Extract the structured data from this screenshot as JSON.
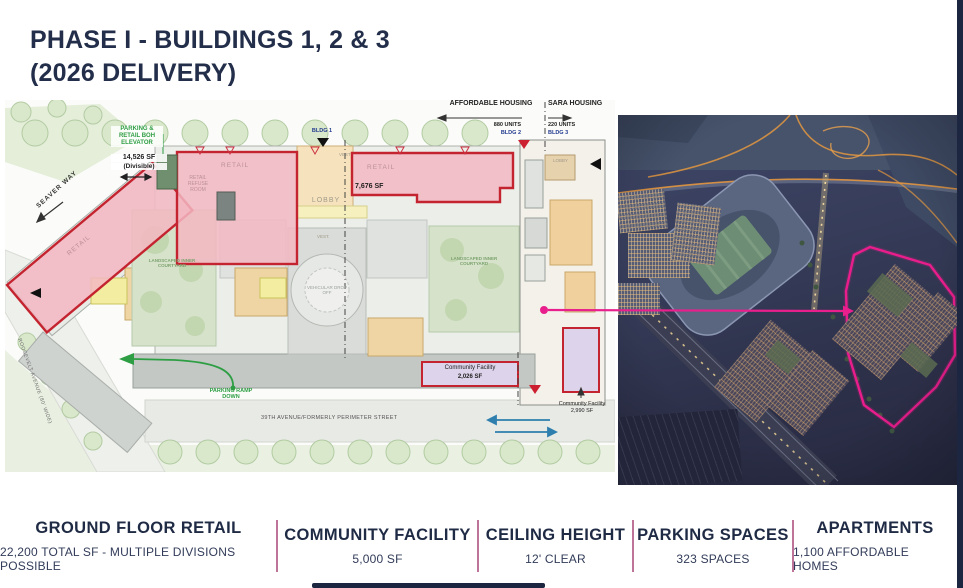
{
  "title": {
    "line1": "PHASE I - BUILDINGS 1, 2 & 3",
    "line2": "(2026 DELIVERY)"
  },
  "plan": {
    "header": {
      "affordable": {
        "title": "AFFORDABLE HOUSING",
        "units": "880 UNITS",
        "bldg": "BLDG 2"
      },
      "sara": {
        "title": "SARA HOUSING",
        "units": "220 UNITS",
        "bldg": "BLDG 3"
      },
      "bldg1": "BLDG 1"
    },
    "labels": {
      "parking_elevator": "PARKING & RETAIL BOH ELEVATOR",
      "sf_divisible": "14,526 SF",
      "sf_divisible_note": "(Divisible)",
      "retail": "RETAIL",
      "refuse_room": "RETAIL REFUSE ROOM",
      "sf_right": "7,676 SF",
      "lobby": "LOBBY",
      "vest_top": "VEST",
      "vest_mid": "VEST.",
      "lobby_bldg3": "LOBBY",
      "dropoff": "VEHICULAR DROP OFF",
      "courtyard": "LANDSCAPED INNER COURTYARD",
      "community1_name": "Community Facility",
      "community1_sf": "2,026 SF",
      "community2_name": "Community Facility",
      "community2_sf": "2,990 SF",
      "parking_ramp": "PARKING RAMP DOWN"
    },
    "streets": {
      "seaver": "SEAVER WAY",
      "roosevelt": "ROOSEVELT AVENUE (80' WIDE)",
      "ave39": "39TH AVENUE/FORMERLY PERIMETER STREET"
    }
  },
  "stats": {
    "items": [
      {
        "label": "GROUND FLOOR RETAIL",
        "value": "22,200 TOTAL SF - MULTIPLE DIVISIONS POSSIBLE"
      },
      {
        "label": "COMMUNITY FACILITY",
        "value": "5,000 SF"
      },
      {
        "label": "CEILING HEIGHT",
        "value": "12' CLEAR"
      },
      {
        "label": "PARKING SPACES",
        "value": "323 SPACES"
      },
      {
        "label": "APARTMENTS",
        "value": "1,100 AFFORDABLE HOMES"
      }
    ]
  },
  "colors": {
    "navy": "#232e4a",
    "divider_pink": "#bd7498",
    "plan_red": "#c4242f",
    "plan_pink_fill": "#f3b7c2",
    "community_purple": "#ddd3ea",
    "accent_magenta": "#e81f8c",
    "green_note": "#2e9e44"
  }
}
